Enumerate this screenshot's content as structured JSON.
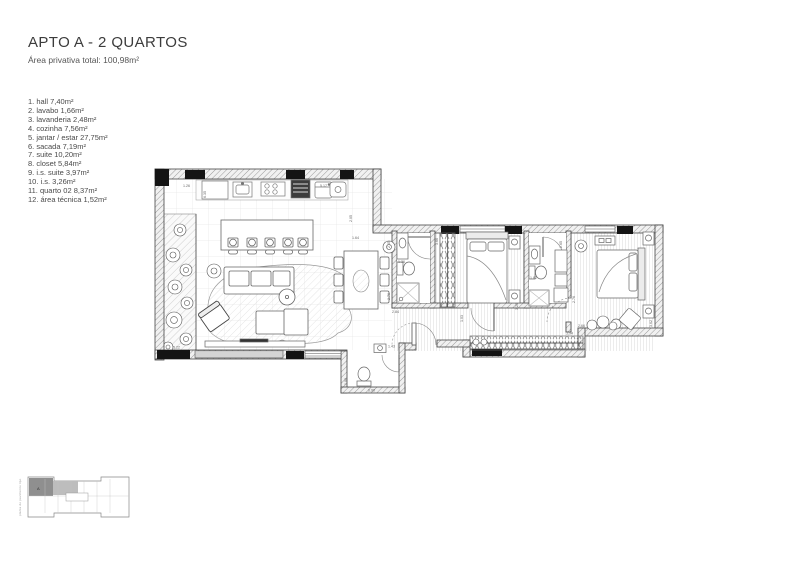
{
  "header": {
    "title": "APTO A - 2 QUARTOS",
    "subtitle": "Área privativa total: 100,98m²"
  },
  "rooms": [
    "1. hall  7,40m²",
    "2. lavabo  1,66m²",
    "3. lavanderia  2,48m²",
    "4. cozinha 7,56m²",
    "5. jantar / estar  27,75m²",
    "6. sacada  7,19m²",
    "7. suite  10,20m²",
    "8. closet  5,84m²",
    "9. i.s. suite  3,97m²",
    "10. i.s.  3,26m²",
    "11. quarto 02  8,37m²",
    "12. área técnica 1,52m²"
  ],
  "plan": {
    "dims": [
      {
        "t": "1.26"
      },
      {
        "t": "5.17"
      },
      {
        "t": "6.35"
      },
      {
        "t": "5.22"
      },
      {
        "t": "2.05"
      },
      {
        "t": "1.64"
      },
      {
        "t": "2.65"
      },
      {
        "t": "1.36"
      },
      {
        "t": "2.76"
      },
      {
        "t": "2.84"
      },
      {
        "t": "3.66"
      },
      {
        "t": "1.03"
      },
      {
        "t": "3.20"
      },
      {
        "t": "1.82"
      },
      {
        "t": "2.65"
      },
      {
        "t": "2.76"
      },
      {
        "t": "2.66"
      },
      {
        "t": "3.94"
      },
      {
        "t": "3.62"
      },
      {
        "t": "1.43"
      },
      {
        "t": "1.00"
      },
      {
        "t": "0.90"
      }
    ]
  },
  "keyplan": {
    "caption": "planta do pavimento tipo",
    "unit_label": "A"
  },
  "colors": {
    "ink": "#3a3a3a",
    "wall_hatch": "#9a9a9a",
    "column": "#141414",
    "keyplan_highlight": "#8f8f8f"
  }
}
